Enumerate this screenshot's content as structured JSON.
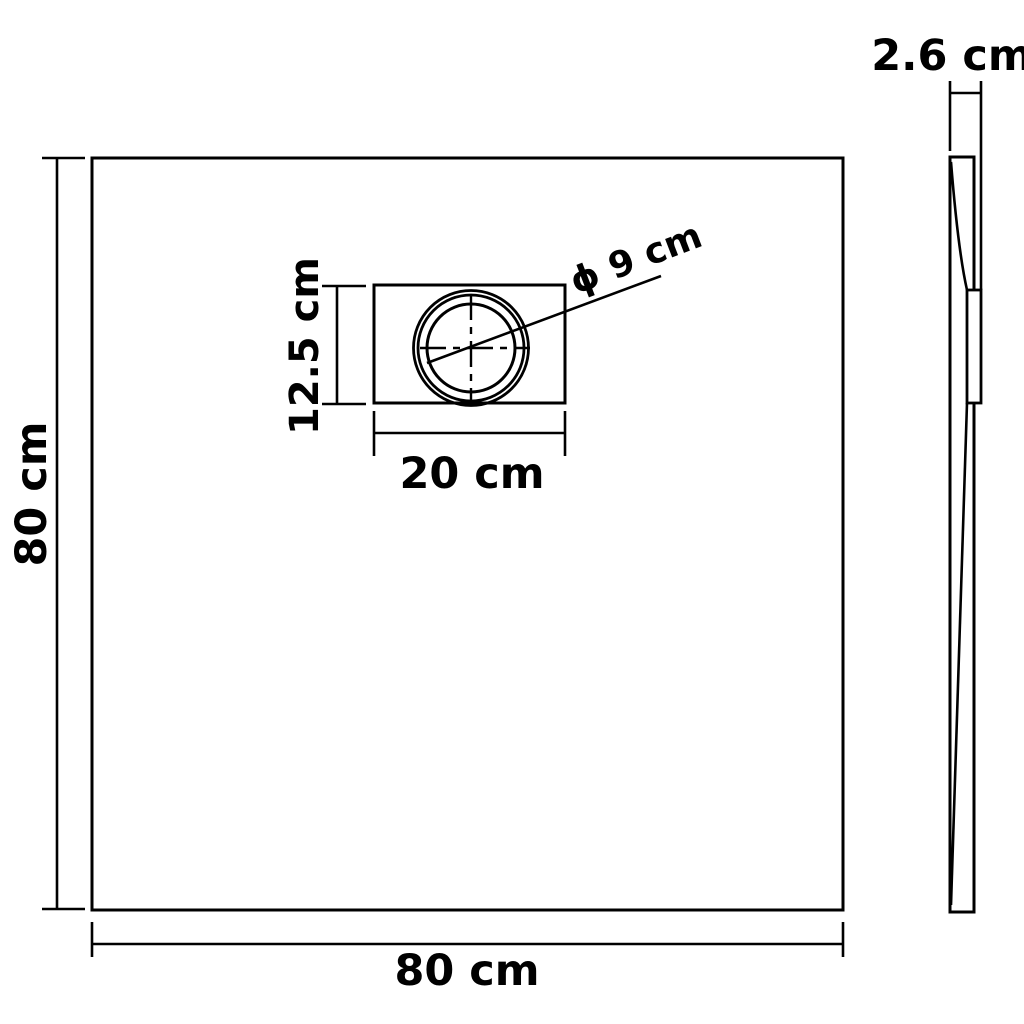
{
  "plan_view": {
    "height_label": "80 cm",
    "width_label": "80 cm",
    "drain": {
      "box_height_label": "12.5 cm",
      "box_width_label": "20 cm",
      "diameter_label": "ϕ 9 cm"
    }
  },
  "side_view": {
    "thickness_label": "2.6 cm"
  },
  "colors": {
    "line": "#000000",
    "background": "#ffffff"
  }
}
